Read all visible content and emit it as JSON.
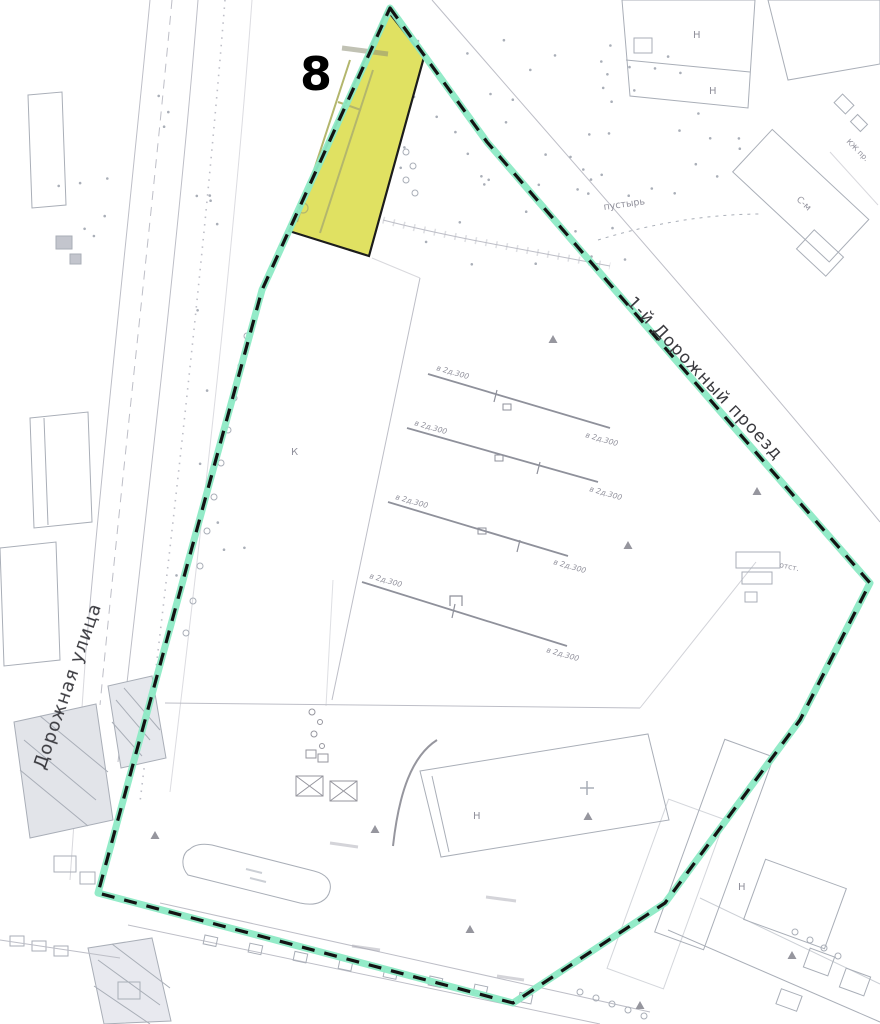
{
  "map": {
    "parcel": {
      "number": "8",
      "fill": "#e0e162",
      "stroke": "#1c1c1c"
    },
    "boundary": {
      "highlight": "#8deac5",
      "dash": "#141414"
    },
    "streets": {
      "left": "Дорожная улица",
      "right": "1-й Дорожный проезд"
    },
    "labels": {
      "pustyr": "пустырь",
      "k": "К",
      "n": "Н",
      "sm": "С-м",
      "otst": "отст.",
      "kzh": "КЖ пр.",
      "utility": "в 2д.300"
    },
    "colors": {
      "linework": "#b2b3bd",
      "building": "#9aa0ab",
      "label_gray": "#90909b",
      "street_text": "#3a3a3f"
    }
  }
}
